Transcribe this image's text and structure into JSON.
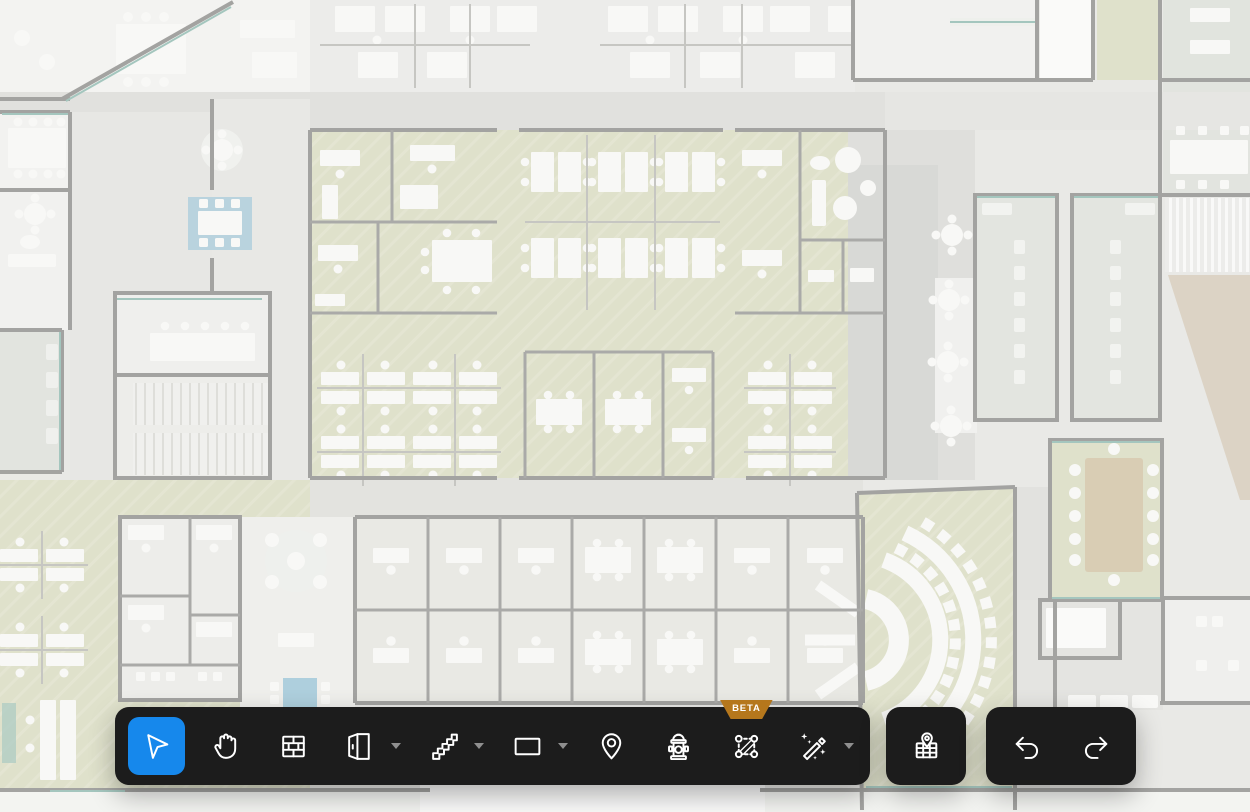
{
  "colors": {
    "accent": "#1688ec",
    "toolbar_bg": "#1c1c1c",
    "beta_bg": "#b5771c",
    "chevron": "#8f8f8f",
    "canvas_base": "#e9e9e6",
    "zone_green": "#dfe1cb",
    "wall_gray": "#a3a3a1",
    "teal_accent": "#a4c6be",
    "blue_rug": "#b9d3de",
    "wood_tan": "#d8cdbd"
  },
  "canvas": {
    "type": "office-floor-plan",
    "state": "faded-background"
  },
  "toolbar": {
    "beta_badge": "BETA",
    "tools": [
      {
        "id": "select",
        "icon": "cursor-icon",
        "selected": true,
        "has_dropdown": false
      },
      {
        "id": "pan",
        "icon": "hand-icon",
        "selected": false,
        "has_dropdown": false
      },
      {
        "id": "wall",
        "icon": "brick-wall-icon",
        "selected": false,
        "has_dropdown": false
      },
      {
        "id": "door",
        "icon": "door-icon",
        "selected": false,
        "has_dropdown": true
      },
      {
        "id": "stairs",
        "icon": "stairs-icon",
        "selected": false,
        "has_dropdown": true
      },
      {
        "id": "rectangle",
        "icon": "rectangle-icon",
        "selected": false,
        "has_dropdown": true
      },
      {
        "id": "place-pin",
        "icon": "location-pin-icon",
        "selected": false,
        "has_dropdown": false
      },
      {
        "id": "fire-hydrant",
        "icon": "fire-hydrant-icon",
        "selected": false,
        "has_dropdown": false
      },
      {
        "id": "zone",
        "icon": "zone-marquee-icon",
        "selected": false,
        "has_dropdown": false,
        "badge": "BETA"
      },
      {
        "id": "magic-wand",
        "icon": "magic-wand-icon",
        "selected": false,
        "has_dropdown": true
      }
    ]
  },
  "secondary_toolbar": {
    "minimap_icon": "map-pin-icon"
  },
  "history_toolbar": {
    "undo_icon": "undo-icon",
    "redo_icon": "redo-icon"
  }
}
